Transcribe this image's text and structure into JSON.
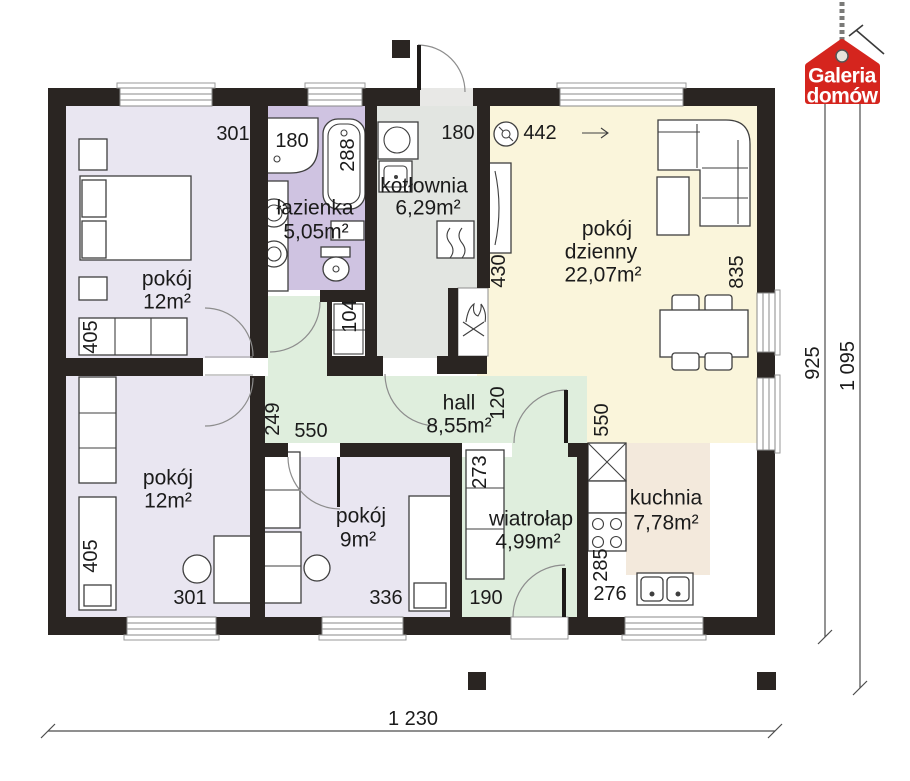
{
  "logo": {
    "line1": "Galeria",
    "line2": "domów"
  },
  "rooms": {
    "bedroom_top": {
      "name": "pokój",
      "area": "12m²"
    },
    "bathroom": {
      "name": "łazienka",
      "area": "5,05m²"
    },
    "boiler_room": {
      "name": "kotłownia",
      "area": "6,29m²"
    },
    "living_room": {
      "name_line1": "pokój",
      "name_line2": "dzienny",
      "area": "22,07m²"
    },
    "hall": {
      "name": "hall",
      "area": "8,55m²"
    },
    "bedroom_bottom": {
      "name": "pokój",
      "area": "12m²"
    },
    "bedroom_small": {
      "name": "pokój",
      "area": "9m²"
    },
    "vestibule": {
      "name": "wiatrołap",
      "area": "4,99m²"
    },
    "kitchen": {
      "name": "kuchnia",
      "area": "7,78m²"
    }
  },
  "dimensions": {
    "overall_width": "1 230",
    "overall_depth": "925",
    "overall_depth_total": "1 095",
    "bedroom_top_width": "301",
    "bedroom_top_depth": "405",
    "shower": "180",
    "bathtub": "288",
    "boiler_room_width": "180",
    "living_vent": "442",
    "radiator": "430",
    "living_window": "835",
    "closet": "104",
    "corridor": "249",
    "hall_width": "550",
    "hall_passage": "120",
    "kitchen_opening": "550",
    "bedroom_bottom_depth": "405",
    "bedroom_bottom_width": "301",
    "bedroom_small_width": "336",
    "vestibule_width": "190",
    "vestibule_wardrobe": "273",
    "kitchen_counter_depth": "285",
    "kitchen_width": "276"
  },
  "colors": {
    "wall": "#2a2522",
    "bedroom": "#e9e6f1",
    "bathroom": "#cfc3e1",
    "boiler_room": "#e2e5e1",
    "living_room": "#faf5db",
    "hall": "#dfeedd",
    "kitchen_counter": "#f3e9dc",
    "logo_red": "#d5251e"
  }
}
